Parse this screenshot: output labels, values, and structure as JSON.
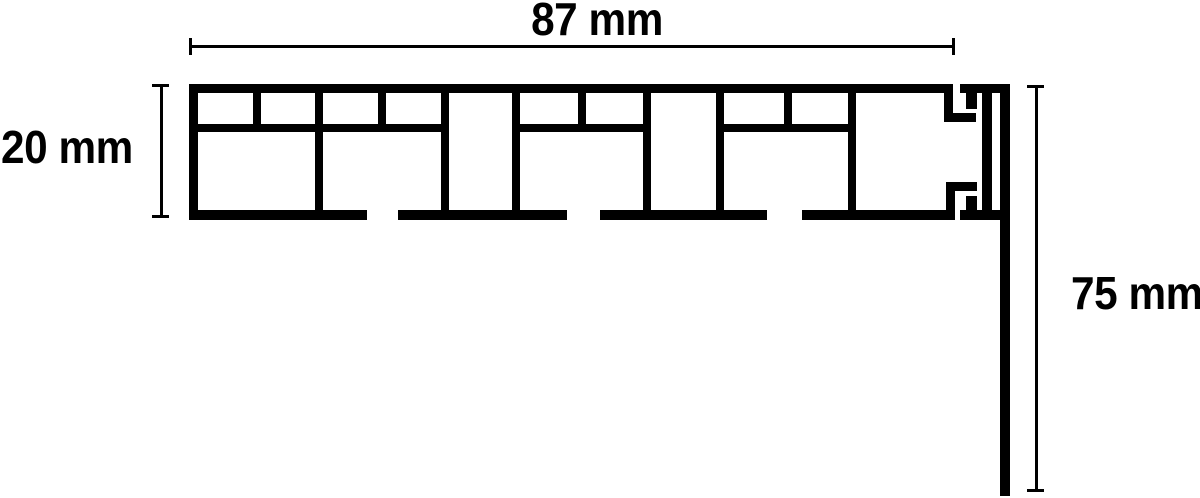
{
  "diagram": {
    "subject": "profile-cross-section",
    "dimensions": {
      "width": {
        "label": "87 mm",
        "value": 87,
        "unit": "mm",
        "orientation": "horizontal"
      },
      "height": {
        "label": "20 mm",
        "value": 20,
        "unit": "mm",
        "orientation": "vertical"
      },
      "drop": {
        "label": "75 mm",
        "value": 75,
        "unit": "mm",
        "orientation": "vertical"
      }
    },
    "colors": {
      "line": "#000000",
      "background": "#ffffff"
    }
  }
}
